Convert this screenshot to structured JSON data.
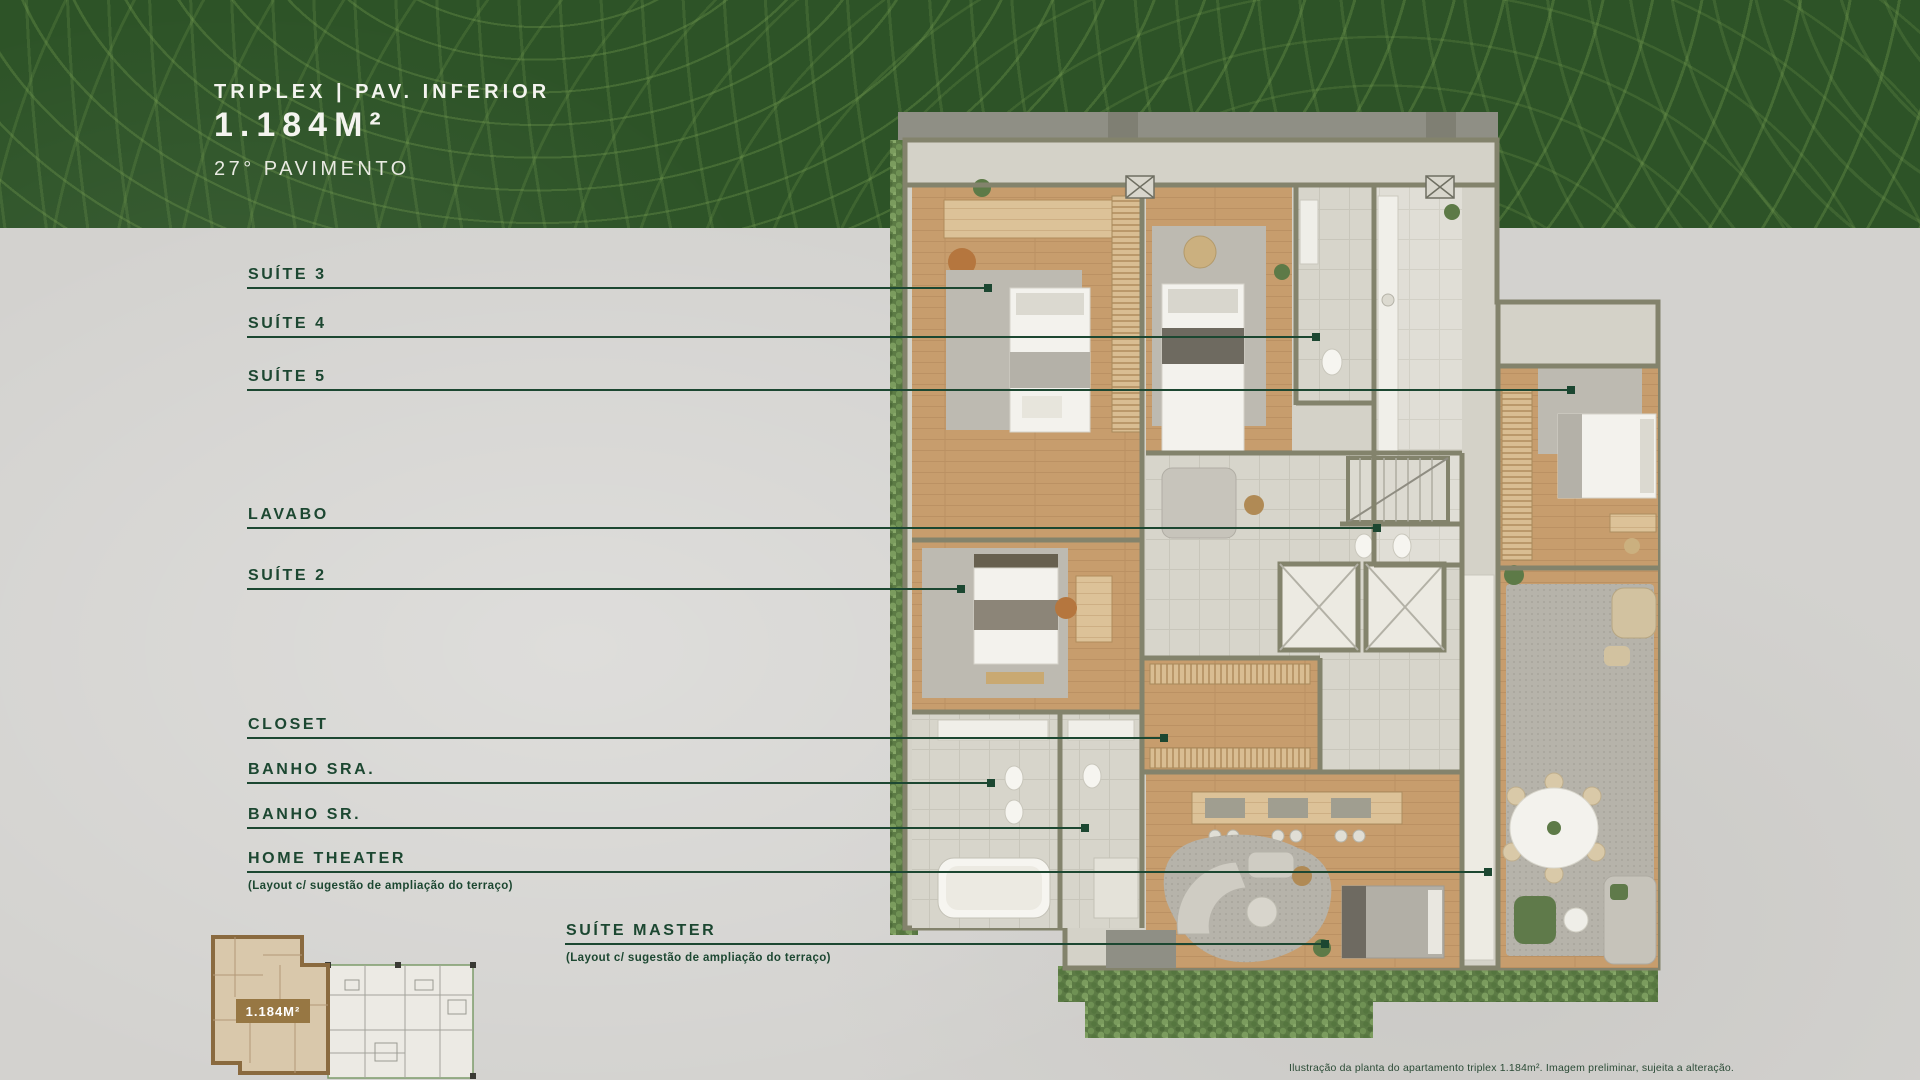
{
  "header": {
    "title": "TRIPLEX | PAV. INFERIOR",
    "area": "1.184M²",
    "floor": "27° PAVIMENTO"
  },
  "callouts": [
    {
      "label": "SUÍTE 3"
    },
    {
      "label": "SUÍTE 4"
    },
    {
      "label": "SUÍTE 5"
    },
    {
      "label": "LAVABO"
    },
    {
      "label": "SUÍTE 2"
    },
    {
      "label": "CLOSET"
    },
    {
      "label": "BANHO SRA."
    },
    {
      "label": "BANHO SR."
    },
    {
      "label": "HOME THEATER",
      "note": "(Layout c/ sugestão de ampliação do terraço)"
    },
    {
      "label": "SUÍTE MASTER",
      "note": "(Layout c/ sugestão de ampliação do terraço)"
    }
  ],
  "keyplan": {
    "badge": "1.184M²"
  },
  "disclaimer": "Ilustração da planta do apartamento triplex 1.184m². Imagem preliminar, sujeita a alteração.",
  "colors": {
    "accent_green": "#1c4731",
    "band_green": "#2d5327",
    "badge_brown": "#977743"
  }
}
